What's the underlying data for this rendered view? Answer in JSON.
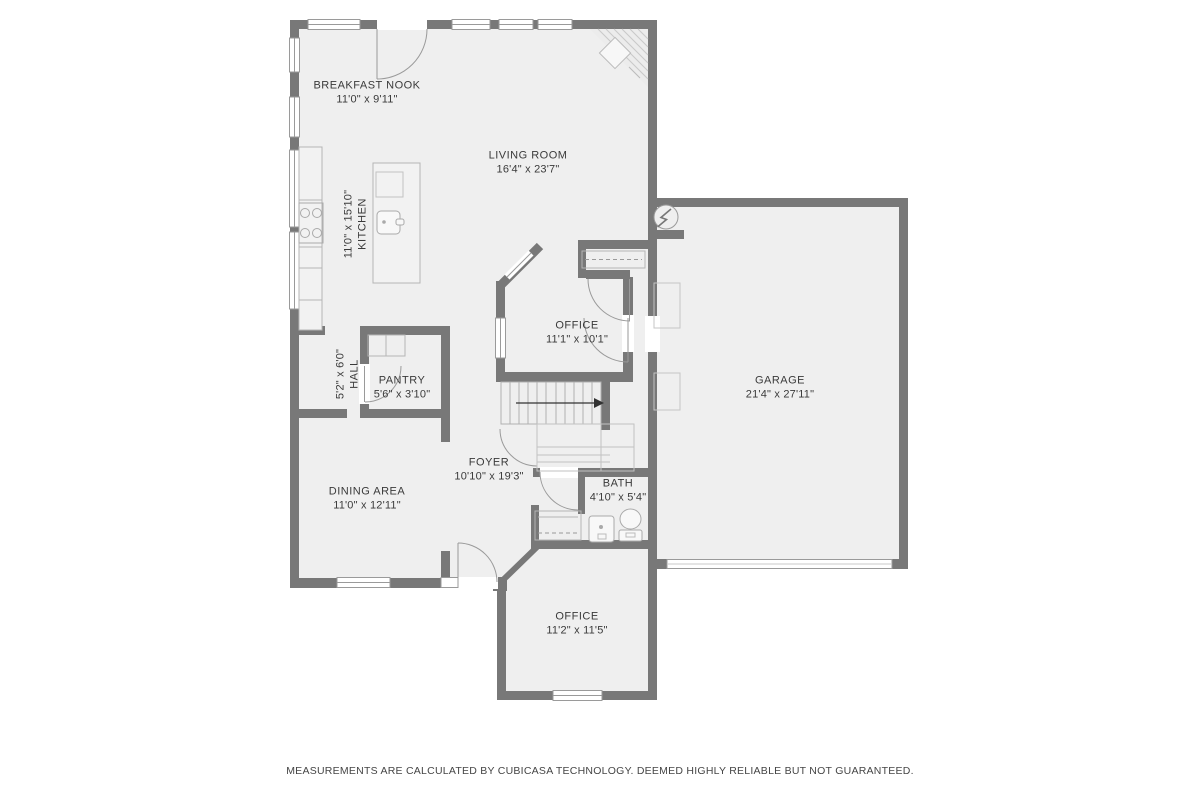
{
  "plan": {
    "type": "floor-plan",
    "colors": {
      "background": "#ffffff",
      "room_fill": "#efefef",
      "wall": "#787878",
      "opening_line": "#9a9a9a",
      "fixture_line": "#b5b5b5",
      "label_text": "#3a3a3a",
      "stairs_arrow": "#333333"
    },
    "symbols": {
      "stairs_arrow": "stairs-direction-arrow",
      "electrical": "lightning-bolt-circle",
      "fireplace": "corner-fireplace-hatch"
    }
  },
  "rooms": [
    {
      "id": "breakfast-nook",
      "name": "BREAKFAST NOOK",
      "dims": "11'0\" x 9'11\""
    },
    {
      "id": "living-room",
      "name": "LIVING ROOM",
      "dims": "16'4\" x 23'7\""
    },
    {
      "id": "kitchen",
      "name": "KITCHEN",
      "dims": "11'0\" x 15'10\""
    },
    {
      "id": "hall",
      "name": "HALL",
      "dims": "5'2\" x 6'0\""
    },
    {
      "id": "pantry",
      "name": "PANTRY",
      "dims": "5'6\" x 3'10\""
    },
    {
      "id": "office-main",
      "name": "OFFICE",
      "dims": "11'1\" x 10'1\""
    },
    {
      "id": "garage",
      "name": "GARAGE",
      "dims": "21'4\" x 27'11\""
    },
    {
      "id": "foyer",
      "name": "FOYER",
      "dims": "10'10\" x 19'3\""
    },
    {
      "id": "dining-area",
      "name": "DINING AREA",
      "dims": "11'0\" x 12'11\""
    },
    {
      "id": "bath",
      "name": "BATH",
      "dims": "4'10\" x 5'4\""
    },
    {
      "id": "office-lower",
      "name": "OFFICE",
      "dims": "11'2\" x 11'5\""
    }
  ],
  "footer": {
    "text": "MEASUREMENTS ARE CALCULATED BY CUBICASA TECHNOLOGY. DEEMED HIGHLY RELIABLE BUT NOT GUARANTEED."
  }
}
